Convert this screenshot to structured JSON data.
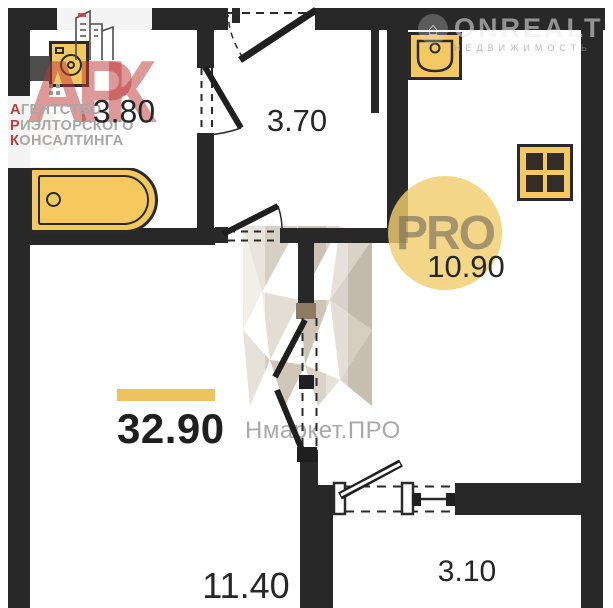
{
  "meta": {
    "type": "apartment-floor-plan",
    "width": 613,
    "height": 608
  },
  "colors": {
    "wall": "#282828",
    "fixture_fill": "#f4c962",
    "fixture_border": "#2a2a2a",
    "accent_bar": "#eec35f",
    "pro_circle": "#f2cd6e",
    "agency_red": "#c03b3b",
    "watermark_gray": "#9a9a9a",
    "label_text": "#262626"
  },
  "rooms": {
    "bathroom": {
      "area": "3.80"
    },
    "hallway": {
      "area": "3.70"
    },
    "kitchen": {
      "area": "10.90"
    },
    "living_total": {
      "area": "32.90"
    },
    "room": {
      "area": "11.40"
    },
    "balcony": {
      "area": "3.10"
    }
  },
  "fixtures": [
    "washing-machine",
    "toilet",
    "bathtub",
    "kitchen-sink",
    "stove"
  ],
  "watermarks": {
    "onrealt": {
      "text": "ONREALT",
      "subtext": "НЕДВИЖИМОСТЬ",
      "icon": "house-in-circle"
    },
    "pro_badge": {
      "text": "PRO"
    },
    "nmarket": {
      "text": "Нмаркет.ПРО"
    },
    "agency": {
      "letters": [
        "А",
        "Р",
        "К"
      ],
      "lines": [
        {
          "first": "А",
          "rest": "ГЕНТСТВО"
        },
        {
          "first": "Р",
          "rest": "ИЭЛТОРСКОГО"
        },
        {
          "first": "К",
          "rest": "ОНСАЛТИНГА"
        }
      ]
    }
  }
}
